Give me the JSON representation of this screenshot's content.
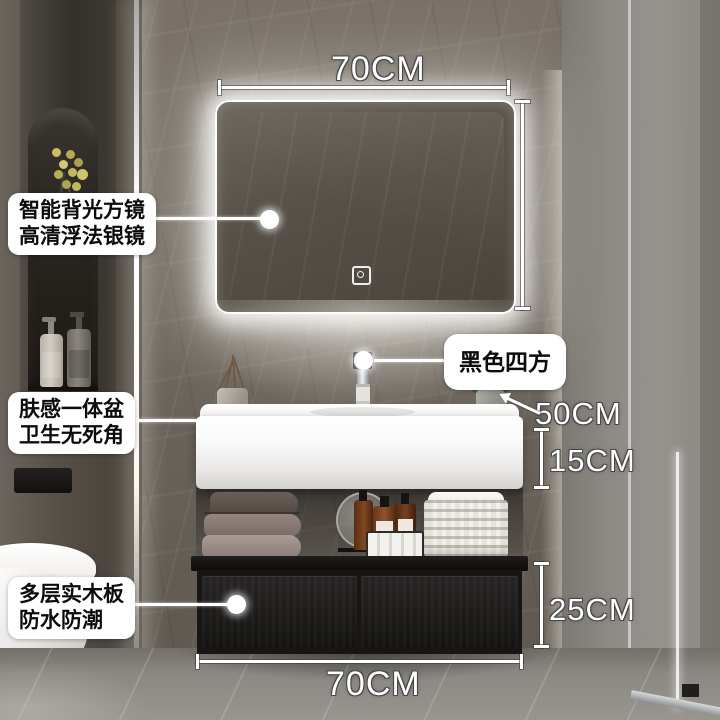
{
  "scene": {
    "description": "bathroom vanity product photo with annotations",
    "colors": {
      "label_bg": "#ffffff",
      "label_text": "#0c0c0c",
      "dimension_text": "#ffffff",
      "cabinet_black": "#1b1a19",
      "basin_white": "#ffffff",
      "led_glow": "#fffdf5",
      "wall_gray": "#6e675f"
    }
  },
  "callouts": {
    "mirror": {
      "line1": "智能背光方镜",
      "line2": "高清浮法银镜"
    },
    "basin": {
      "line1": "肤感一体盆",
      "line2": "卫生无死角"
    },
    "faucet": {
      "label": "黑色四方"
    },
    "cabinet": {
      "line1": "多层实木板",
      "line2": "防水防潮"
    }
  },
  "dimensions": {
    "mirror_width": "70CM",
    "counter_depth": "50CM",
    "basin_height": "15CM",
    "cabinet_height": "25CM",
    "cabinet_width": "70CM"
  },
  "icons": {
    "mirror_touch_sensor": "power-touch-sensor-icon"
  }
}
